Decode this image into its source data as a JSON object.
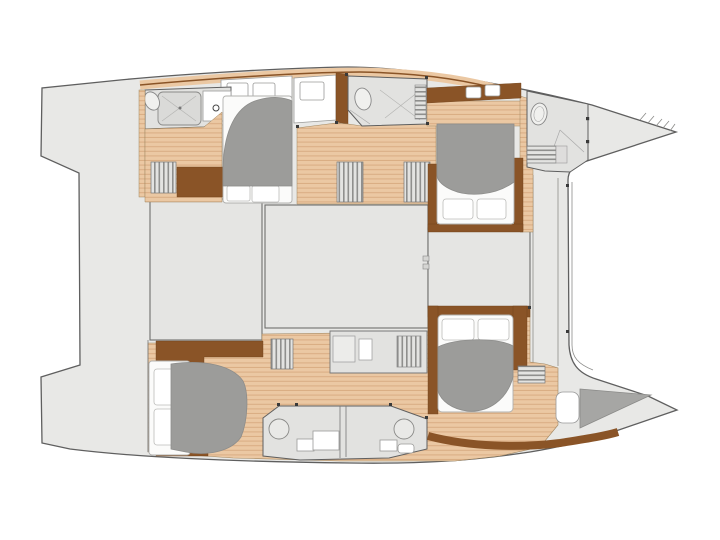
{
  "meta": {
    "title": "Catamaran yacht interior deck plan (top view, bow to the right)",
    "diagram_type": "boat floor plan",
    "visible_text": "none"
  },
  "palette": {
    "background": "#ffffff",
    "deck": "#e8e8e6",
    "panel": "#e5e5e3",
    "wood": "#ebc8a3",
    "wood_stripe": "#d9ac83",
    "wood_dark": "#8a5427",
    "bed_gray": "#9c9c9a",
    "bed_white": "#fbfbfa",
    "bath": "#e2e2e0",
    "outline": "#5f5f5f",
    "fixture": "#8c8c8a",
    "dot": "#3a3a3a"
  },
  "features": {
    "hulls": 2,
    "double_berths": 4,
    "bathrooms": 4,
    "stern_swim_platforms": 2,
    "bow_peaks": 2,
    "salon_sections": 3,
    "stair_flights": 4,
    "bow_sunpad": 1,
    "bow_hatch": 1
  }
}
